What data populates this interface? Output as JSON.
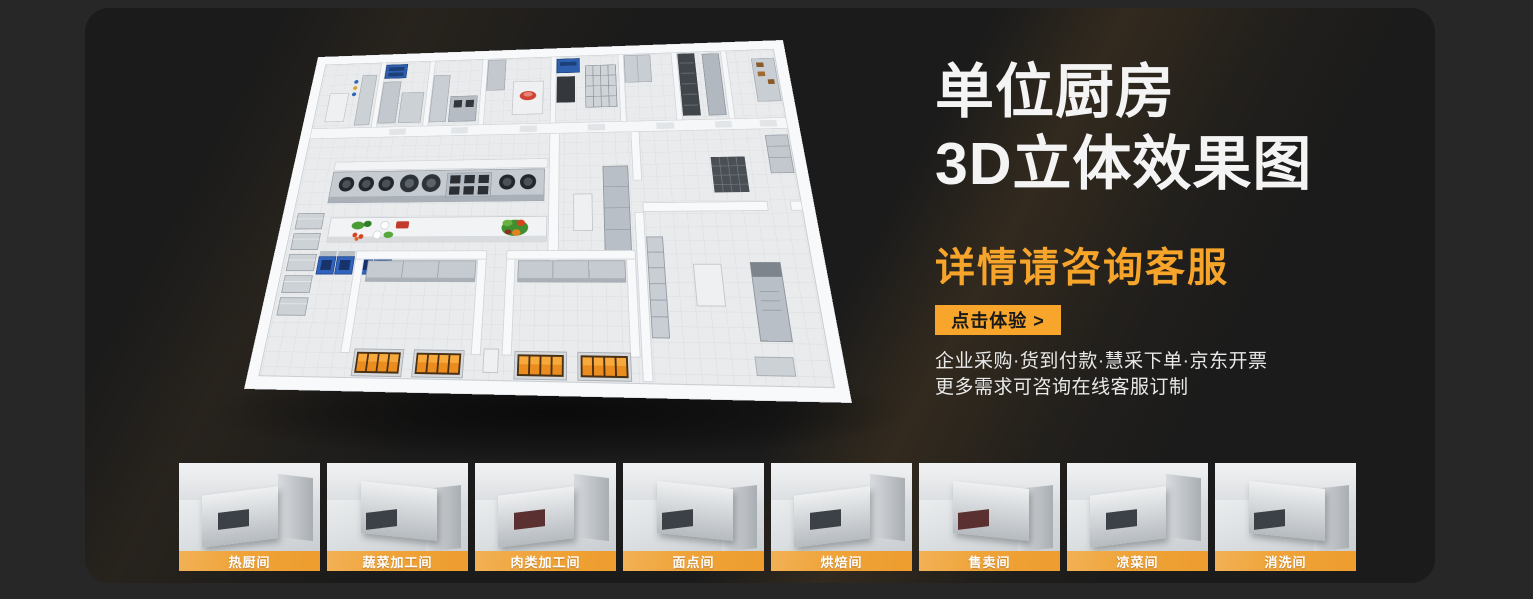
{
  "hero": {
    "title_line1": "单位厨房",
    "title_line2": "3D立体效果图",
    "subtitle": "详情请咨询客服",
    "cta_label": "点击体验 >",
    "note_line1": "企业采购·货到付款·慧采下单·京东开票",
    "note_line2": "更多需求可咨询在线客服订制"
  },
  "colors": {
    "accent_orange": "#F7A52B",
    "subtitle_orange": "#F7A42A",
    "panel_bg": "#1B1B1B",
    "page_bg": "#272727",
    "title_white": "#F4F4F4",
    "thumb_band_gradient": [
      "#F2B156",
      "#EE9D2E"
    ]
  },
  "thumbnails": [
    {
      "label": "热厨间"
    },
    {
      "label": "蔬菜加工间"
    },
    {
      "label": "肉类加工间"
    },
    {
      "label": "面点间"
    },
    {
      "label": "烘焙间"
    },
    {
      "label": "售卖间"
    },
    {
      "label": "凉菜间"
    },
    {
      "label": "消洗间"
    }
  ]
}
